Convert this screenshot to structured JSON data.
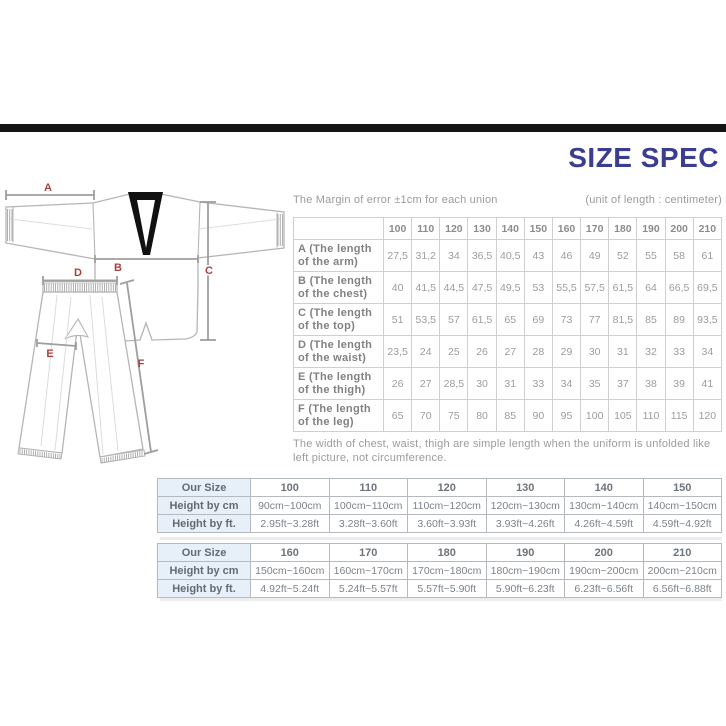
{
  "page": {
    "title": "SIZE SPEC"
  },
  "notes": {
    "margin": "The Margin of error ±1cm for each union",
    "unit": "(unit of length : centimeter)"
  },
  "spec_table": {
    "columns": [
      "100",
      "110",
      "120",
      "130",
      "140",
      "150",
      "160",
      "170",
      "180",
      "190",
      "200",
      "210"
    ],
    "rows": [
      {
        "label": [
          "A (The length",
          "of the arm)"
        ],
        "values": [
          "27,5",
          "31,2",
          "34",
          "36,5",
          "40,5",
          "43",
          "46",
          "49",
          "52",
          "55",
          "58",
          "61"
        ]
      },
      {
        "label": [
          "B (The length",
          "of the chest)"
        ],
        "values": [
          "40",
          "41,5",
          "44,5",
          "47,5",
          "49,5",
          "53",
          "55,5",
          "57,5",
          "61,5",
          "64",
          "66,5",
          "69,5"
        ]
      },
      {
        "label": [
          "C (The length",
          "of the top)"
        ],
        "values": [
          "51",
          "53,5",
          "57",
          "61,5",
          "65",
          "69",
          "73",
          "77",
          "81,5",
          "85",
          "89",
          "93,5"
        ]
      },
      {
        "label": [
          "D (The length",
          "of the waist)"
        ],
        "values": [
          "23,5",
          "24",
          "25",
          "26",
          "27",
          "28",
          "29",
          "30",
          "31",
          "32",
          "33",
          "34"
        ]
      },
      {
        "label": [
          "E (The length",
          "of the thigh)"
        ],
        "values": [
          "26",
          "27",
          "28,5",
          "30",
          "31",
          "33",
          "34",
          "35",
          "37",
          "38",
          "39",
          "41"
        ]
      },
      {
        "label": [
          "F (The length",
          "of the leg)"
        ],
        "values": [
          "65",
          "70",
          "75",
          "80",
          "85",
          "90",
          "95",
          "100",
          "105",
          "110",
          "115",
          "120"
        ]
      }
    ],
    "footnote": "The width of chest, waist, thigh are simple length when the uniform is unfolded like left picture, not circumference."
  },
  "size_tables": {
    "size_label": "Our Size",
    "cm_label": "Height by cm",
    "ft_label": "Height by ft.",
    "groups": [
      {
        "sizes": [
          "100",
          "110",
          "120",
          "130",
          "140",
          "150"
        ],
        "cm": [
          "90cm~100cm",
          "100cm~110cm",
          "110cm~120cm",
          "120cm~130cm",
          "130cm~140cm",
          "140cm~150cm"
        ],
        "ft": [
          "2.95ft~3.28ft",
          "3.28ft~3.60ft",
          "3.60ft~3.93ft",
          "3.93ft~4.26ft",
          "4.26ft~4.59ft",
          "4.59ft~4.92ft"
        ]
      },
      {
        "sizes": [
          "160",
          "170",
          "180",
          "190",
          "200",
          "210"
        ],
        "cm": [
          "150cm~160cm",
          "160cm~170cm",
          "170cm~180cm",
          "180cm~190cm",
          "190cm~200cm",
          "200cm~210cm"
        ],
        "ft": [
          "4.92ft~5.24ft",
          "5.24ft~5.57ft",
          "5.57ft~5.90ft",
          "5.90ft~6.23ft",
          "6.23ft~6.56ft",
          "6.56ft~6.88ft"
        ]
      }
    ]
  },
  "diagram": {
    "labels": [
      "A",
      "B",
      "C",
      "D",
      "E",
      "F"
    ]
  },
  "colors": {
    "title": "#3b3e90",
    "measure_label": "#a9403d",
    "top_bar": "#151515",
    "size_label_bg": "#e7eff8",
    "garment_outline": "#b5b5b5",
    "collar": "#111111"
  }
}
